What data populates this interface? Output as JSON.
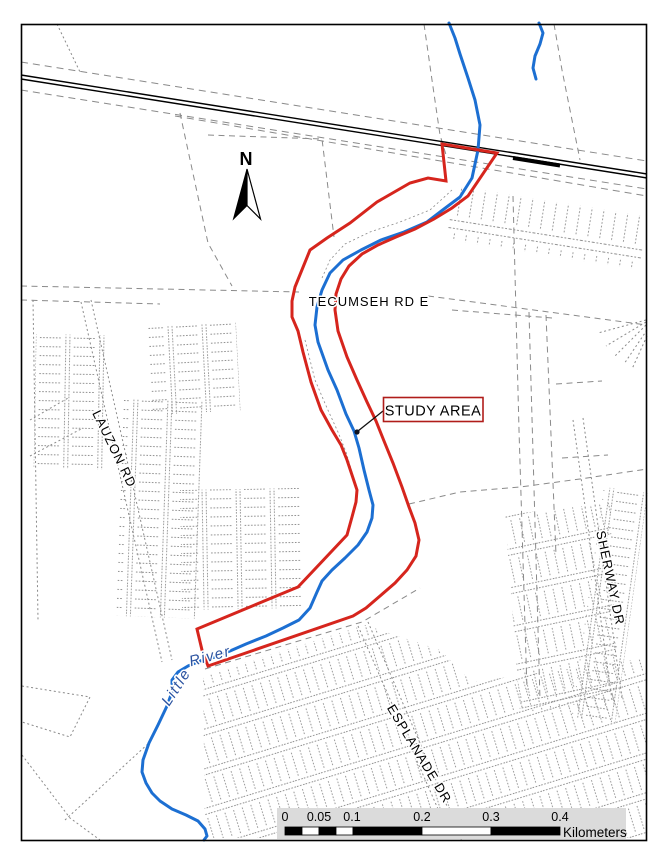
{
  "map": {
    "north_label": "N",
    "labels": {
      "study_area": "STUDY AREA",
      "tecumseh": "TECUMSEH RD E",
      "lauzon": "LAUZON RD",
      "sherway": "SHERWAY DR",
      "esplanade": "ESPLANADE DR",
      "river_word1": "Little",
      "river_word2": "River"
    },
    "scalebar": {
      "ticks": [
        "0",
        "0.05",
        "0.1",
        "0.2",
        "0.3",
        "0.4"
      ],
      "unit": "Kilometers",
      "tick_xs": [
        285,
        319,
        352,
        422,
        491,
        560
      ],
      "tick_y": 821,
      "unit_x": 563,
      "unit_y": 837,
      "bg": [
        277,
        808,
        349,
        31
      ],
      "bar_y": 827,
      "bar_h": 8,
      "segments": [
        [
          285,
          17,
          1
        ],
        [
          302,
          17,
          0
        ],
        [
          319,
          17,
          1
        ],
        [
          336,
          17,
          0
        ],
        [
          353,
          69,
          1
        ],
        [
          422,
          69,
          0
        ],
        [
          491,
          69,
          1
        ]
      ]
    },
    "colors": {
      "study_area": "#D6251D",
      "river": "#1C6FD2",
      "river_label": "#2A52A0",
      "parcel": "#8A8A8A",
      "rail": "#000000",
      "scalebar_bg": "#DBDBDB",
      "label_box_border": "#B01D1A"
    },
    "geometry": {
      "river_main": [
        [
          449,
          23
        ],
        [
          455,
          38
        ],
        [
          460,
          54
        ],
        [
          468,
          78
        ],
        [
          475,
          100
        ],
        [
          480,
          125
        ],
        [
          478,
          150
        ],
        [
          472,
          178
        ],
        [
          460,
          197
        ],
        [
          444,
          209
        ],
        [
          427,
          222
        ],
        [
          404,
          232
        ],
        [
          381,
          240
        ],
        [
          361,
          250
        ],
        [
          343,
          260
        ],
        [
          330,
          273
        ],
        [
          322,
          290
        ],
        [
          317,
          307
        ],
        [
          315,
          325
        ],
        [
          318,
          342
        ],
        [
          328,
          370
        ],
        [
          337,
          390
        ],
        [
          346,
          414
        ],
        [
          354,
          431
        ],
        [
          359,
          448
        ],
        [
          364,
          470
        ],
        [
          369,
          490
        ],
        [
          373,
          505
        ],
        [
          372,
          518
        ],
        [
          367,
          532
        ],
        [
          358,
          545
        ],
        [
          345,
          558
        ],
        [
          332,
          570
        ],
        [
          322,
          581
        ],
        [
          317,
          592
        ],
        [
          310,
          608
        ],
        [
          299,
          620
        ],
        [
          283,
          628
        ],
        [
          266,
          636
        ],
        [
          246,
          644
        ],
        [
          230,
          651
        ],
        [
          215,
          657
        ],
        [
          200,
          661
        ],
        [
          188,
          666
        ],
        [
          178,
          672
        ],
        [
          172,
          680
        ],
        [
          172,
          692
        ],
        [
          167,
          706
        ],
        [
          158,
          725
        ],
        [
          149,
          743
        ],
        [
          143,
          760
        ],
        [
          142,
          772
        ],
        [
          146,
          783
        ],
        [
          152,
          793
        ],
        [
          160,
          801
        ],
        [
          172,
          809
        ],
        [
          186,
          815
        ],
        [
          198,
          821
        ],
        [
          205,
          829
        ],
        [
          207,
          836
        ],
        [
          204,
          840
        ]
      ],
      "river_tributary": [
        [
          539,
          23
        ],
        [
          543,
          33
        ],
        [
          540,
          44
        ],
        [
          535,
          56
        ],
        [
          533,
          68
        ],
        [
          536,
          79
        ]
      ],
      "study_area_polygon": [
        [
          442,
          144
        ],
        [
          497,
          153
        ],
        [
          468,
          196
        ],
        [
          452,
          208
        ],
        [
          434,
          219
        ],
        [
          415,
          229
        ],
        [
          396,
          237
        ],
        [
          378,
          245
        ],
        [
          362,
          254
        ],
        [
          349,
          266
        ],
        [
          341,
          279
        ],
        [
          336,
          294
        ],
        [
          335,
          310
        ],
        [
          338,
          331
        ],
        [
          347,
          357
        ],
        [
          357,
          380
        ],
        [
          367,
          402
        ],
        [
          376,
          421
        ],
        [
          384,
          441
        ],
        [
          393,
          463
        ],
        [
          402,
          487
        ],
        [
          409,
          507
        ],
        [
          415,
          523
        ],
        [
          419,
          540
        ],
        [
          416,
          556
        ],
        [
          407,
          570
        ],
        [
          395,
          583
        ],
        [
          380,
          596
        ],
        [
          366,
          608
        ],
        [
          353,
          616
        ],
        [
          208,
          666
        ],
        [
          202,
          650
        ],
        [
          197,
          629
        ],
        [
          298,
          587
        ],
        [
          347,
          535
        ],
        [
          352,
          517
        ],
        [
          356,
          502
        ],
        [
          357,
          490
        ],
        [
          353,
          478
        ],
        [
          347,
          460
        ],
        [
          341,
          445
        ],
        [
          332,
          430
        ],
        [
          321,
          410
        ],
        [
          311,
          382
        ],
        [
          303,
          352
        ],
        [
          298,
          331
        ],
        [
          292,
          317
        ],
        [
          292,
          301
        ],
        [
          295,
          287
        ],
        [
          310,
          250
        ],
        [
          327,
          238
        ],
        [
          350,
          223
        ],
        [
          377,
          202
        ],
        [
          410,
          183
        ],
        [
          428,
          178
        ],
        [
          446,
          181
        ]
      ],
      "railroad": {
        "x1": 21,
        "y1": 77,
        "x2": 647,
        "y2": 176,
        "thick": [
          513,
          158,
          560,
          165.5
        ]
      },
      "leader": {
        "x1": 383,
        "y1": 411,
        "x2": 358,
        "y2": 431,
        "dot": [
          357,
          432
        ]
      },
      "parcel_lines": [
        {
          "pts": [
            [
              21,
              62
            ],
            [
              647,
              161
            ]
          ],
          "d": "rdash"
        },
        {
          "pts": [
            [
              21,
              90
            ],
            [
              647,
              189
            ]
          ],
          "d": "rdash"
        },
        {
          "pts": [
            [
              175,
              116
            ],
            [
              647,
              196
            ]
          ],
          "d": "rdash"
        },
        {
          "pts": [
            [
              57,
              24
            ],
            [
              80,
              72
            ]
          ],
          "d": "dot"
        },
        {
          "pts": [
            [
              180,
              113
            ],
            [
              186,
              141
            ],
            [
              208,
              243
            ],
            [
              232,
              286
            ]
          ],
          "d": "dash"
        },
        {
          "pts": [
            [
              208,
              135
            ],
            [
              322,
              139
            ],
            [
              334,
              237
            ]
          ],
          "d": "dash"
        },
        {
          "pts": [
            [
              21,
              286
            ],
            [
              299,
              292
            ]
          ],
          "d": "dash"
        },
        {
          "pts": [
            [
              21,
              300
            ],
            [
              160,
              304
            ]
          ],
          "d": "dash"
        },
        {
          "pts": [
            [
              428,
              296
            ],
            [
              647,
              325
            ]
          ],
          "d": "dash"
        },
        {
          "pts": [
            [
              452,
              310
            ],
            [
              552,
              318
            ]
          ],
          "d": "dash"
        },
        {
          "pts": [
            [
              81,
              302
            ],
            [
              162,
              662
            ]
          ],
          "d": "dot"
        },
        {
          "pts": [
            [
              91,
              300
            ],
            [
              172,
              660
            ]
          ],
          "d": "dot"
        },
        {
          "pts": [
            [
              30,
              420
            ],
            [
              68,
              398
            ]
          ],
          "d": "dot"
        },
        {
          "pts": [
            [
              30,
              456
            ],
            [
              83,
              428
            ]
          ],
          "d": "dot"
        },
        {
          "pts": [
            [
              33,
              300
            ],
            [
              38,
              620
            ]
          ],
          "d": "dot"
        },
        {
          "pts": [
            [
              358,
              626
            ],
            [
              452,
              841
            ]
          ],
          "d": "dot"
        },
        {
          "pts": [
            [
              368,
              622
            ],
            [
              462,
              841
            ]
          ],
          "d": "dot"
        },
        {
          "pts": [
            [
              573,
              420
            ],
            [
              612,
              700
            ]
          ],
          "d": "dot"
        },
        {
          "pts": [
            [
              583,
              418
            ],
            [
              622,
              698
            ]
          ],
          "d": "dot"
        },
        {
          "pts": [
            [
              205,
              669
            ],
            [
              362,
              622
            ],
            [
              420,
              588
            ]
          ],
          "d": "dash"
        },
        {
          "pts": [
            [
              409,
              504
            ],
            [
              460,
              492
            ],
            [
              520,
              487
            ],
            [
              580,
              479
            ],
            [
              647,
              469
            ]
          ],
          "d": "dash"
        },
        {
          "pts": [
            [
              513,
              196
            ],
            [
              519,
              430
            ],
            [
              527,
              690
            ]
          ],
          "d": "dash"
        },
        {
          "pts": [
            [
              529,
              312
            ],
            [
              540,
              700
            ]
          ],
          "d": "dash"
        },
        {
          "pts": [
            [
              546,
              315
            ],
            [
              556,
              555
            ]
          ],
          "d": "dash"
        },
        {
          "pts": [
            [
              556,
              384
            ],
            [
              602,
              381
            ]
          ],
          "d": "dash"
        },
        {
          "pts": [
            [
              562,
              458
            ],
            [
              608,
              455
            ]
          ],
          "d": "dash"
        },
        {
          "pts": [
            [
              646,
              320
            ],
            [
              598,
              333
            ]
          ],
          "d": "dot"
        },
        {
          "pts": [
            [
              646,
              322
            ],
            [
              606,
              346
            ]
          ],
          "d": "dot"
        },
        {
          "pts": [
            [
              646,
              325
            ],
            [
              614,
              357
            ]
          ],
          "d": "dot"
        },
        {
          "pts": [
            [
              647,
              330
            ],
            [
              624,
              364
            ]
          ],
          "d": "dot"
        },
        {
          "pts": [
            [
              647,
              336
            ],
            [
              632,
              369
            ]
          ],
          "d": "dot"
        },
        {
          "pts": [
            [
              22,
              686
            ],
            [
              90,
              697
            ],
            [
              70,
              737
            ],
            [
              22,
              722
            ]
          ],
          "d": "dot"
        },
        {
          "pts": [
            [
              22,
              755
            ],
            [
              70,
              818
            ],
            [
              100,
              840
            ]
          ],
          "d": "dot"
        },
        {
          "pts": [
            [
              65,
              820
            ],
            [
              150,
              742
            ]
          ],
          "d": "dot"
        },
        {
          "pts": [
            [
              424,
              24
            ],
            [
              432,
              80
            ],
            [
              440,
              135
            ],
            [
              447,
              158
            ]
          ],
          "d": "dash"
        },
        {
          "pts": [
            [
              554,
              24
            ],
            [
              562,
              70
            ],
            [
              572,
              120
            ],
            [
              580,
              160
            ]
          ],
          "d": "dash"
        },
        {
          "pts": [
            [
              452,
              190
            ],
            [
              430,
              210
            ],
            [
              400,
              222
            ],
            [
              370,
              232
            ],
            [
              345,
              244
            ],
            [
              330,
              260
            ],
            [
              322,
              278
            ]
          ],
          "d": "dot",
          "w": 0.8
        },
        {
          "pts": [
            [
              305,
              340
            ],
            [
              315,
              380
            ],
            [
              327,
              408
            ],
            [
              338,
              432
            ],
            [
              346,
              452
            ],
            [
              352,
              472
            ],
            [
              357,
              492
            ]
          ],
          "d": "dot",
          "w": 0.8
        }
      ],
      "textures": [
        {
          "kind": "rect",
          "pat": "ladderV",
          "x": 36,
          "y": 334,
          "w": 70,
          "h": 134,
          "r": 1
        },
        {
          "kind": "rect",
          "pat": "ladderV",
          "x": 148,
          "y": 327,
          "w": 88,
          "h": 88,
          "r": -3
        },
        {
          "kind": "rect",
          "pat": "ladderV",
          "x": 124,
          "y": 398,
          "w": 80,
          "h": 218,
          "r": 2
        },
        {
          "kind": "rect",
          "pat": "ladderV",
          "x": 180,
          "y": 490,
          "w": 120,
          "h": 120,
          "r": -1
        },
        {
          "kind": "rect",
          "pat": "lots",
          "x": 455,
          "y": 186,
          "w": 195,
          "h": 54,
          "r": 9
        },
        {
          "kind": "rect",
          "pat": "ladderV",
          "x": 604,
          "y": 487,
          "w": 44,
          "h": 232,
          "r": 8
        },
        {
          "kind": "poly",
          "pat": "grid2",
          "pts": [
            [
              505,
              515
            ],
            [
              610,
              503
            ],
            [
              618,
              705
            ],
            [
              520,
              712
            ]
          ]
        },
        {
          "kind": "poly",
          "pat": "grid",
          "pts": [
            [
              203,
              676
            ],
            [
              365,
              625
            ],
            [
              440,
              650
            ],
            [
              472,
              682
            ],
            [
              560,
              670
            ],
            [
              647,
              658
            ],
            [
              647,
              838
            ],
            [
              205,
              838
            ]
          ]
        }
      ]
    }
  }
}
